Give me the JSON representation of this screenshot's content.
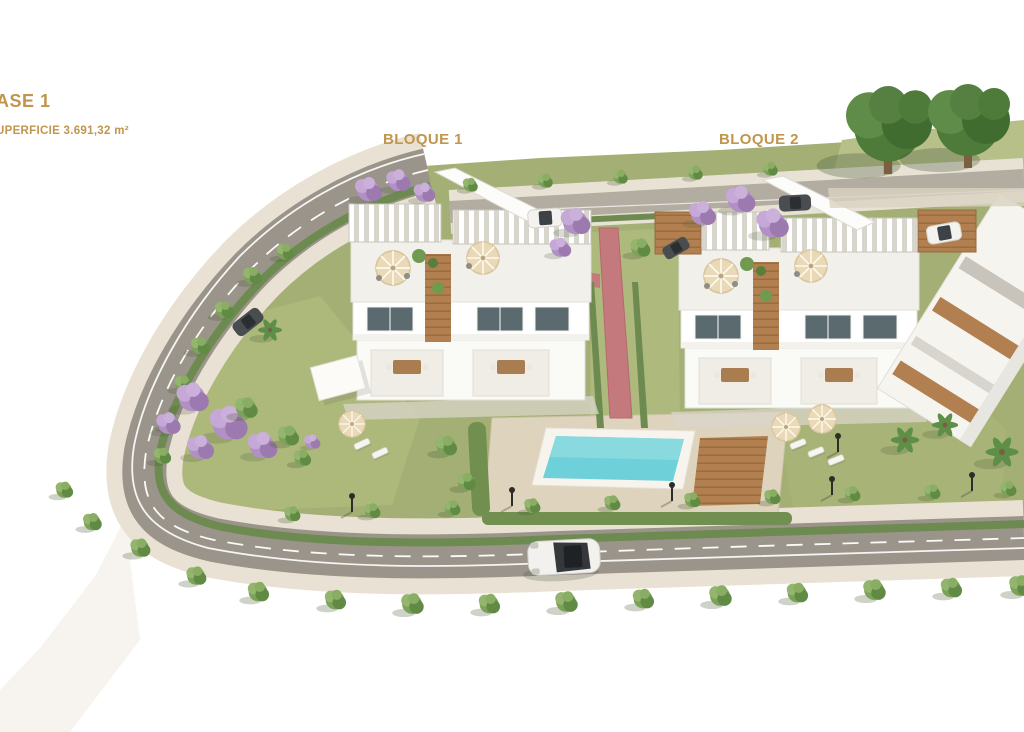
{
  "render": {
    "title": "Aerial 3D architectural render of a residential development phase",
    "description": "Bird's-eye render of two white three-storey apartment blocks with roof terraces, a communal pool with wooden deck, lawns, jacaranda and round trees, palm trees, and a curving perimeter road with cars and street lamps on white ground."
  },
  "labels": {
    "phase": "ASE 1",
    "surface": "UPERFICIE 3.691,32 m²",
    "block1": "BLOQUE 1",
    "block2": "BLOQUE 2"
  },
  "colors": {
    "label_gold": "#c0954e",
    "grass": "#a3af74",
    "grass_light": "#aeb97c",
    "hedge": "#6d8a50",
    "tree_green": "#7ca25a",
    "tree_dark": "#4e7a3a",
    "jacaranda_purple": "#b190c5",
    "road_gray": "#9b948a",
    "top_road_gray": "#b3aca1",
    "sidewalk": "#e9e2d4",
    "pool_water": "#6ed0d8",
    "pool_deck": "#ded3bd",
    "wood": "#ab7d51",
    "path_red": "#c4797d",
    "building_white": "#fbfbf8",
    "window_glass": "#5b6a6e"
  }
}
